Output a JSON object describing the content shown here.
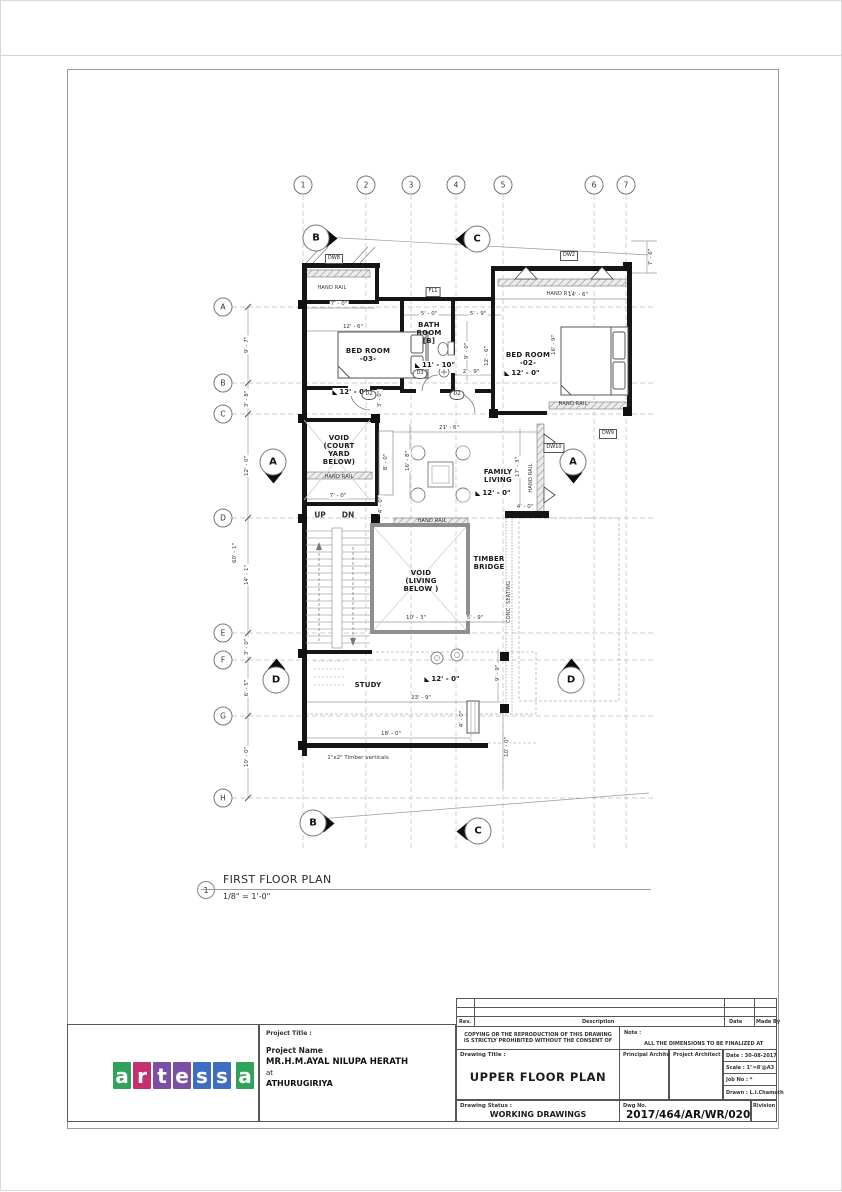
{
  "plan": {
    "number": "1",
    "title": "FIRST FLOOR PLAN",
    "scale": "1/8\" = 1'-0\""
  },
  "grid": {
    "cols": [
      "1",
      "2",
      "3",
      "4",
      "5",
      "6",
      "7"
    ],
    "rows": [
      "A",
      "B",
      "C",
      "D",
      "E",
      "F",
      "G",
      "H"
    ]
  },
  "left_dims": {
    "ab": "9' - 7\"",
    "bc": "3' - 8\"",
    "cd": "12' - 0\"",
    "de": "14' - 1\"",
    "ef": "3' - 0\"",
    "fg": "6' - 5\"",
    "gh": "10' - 0\"",
    "overall": "60' - 1\""
  },
  "section_markers": {
    "top_left": "B",
    "top_right": "C",
    "mid_left": "A",
    "mid_right": "A",
    "low_left": "D",
    "low_right": "D",
    "bottom_left": "B",
    "bottom_right": "C"
  },
  "rooms": {
    "bed3": "BED ROOM\n-03-",
    "bath": "BATH\nROOM\n[B]",
    "bed2": "BED ROOM\n-02-",
    "court": "VOID\n(COURT\nYARD\nBELOW)",
    "family": "FAMILY\nLIVING",
    "void_living": "VOID\n(LIVING\nBELOW )",
    "timber": "TIMBER\nBRIDGE",
    "study": "STUDY"
  },
  "levels": {
    "bed3": "12' - 0\"",
    "bath": "11' - 10\"",
    "bed2": "12' - 0\"",
    "family": "12' - 0\"",
    "study": "12' - 0\""
  },
  "annotations": {
    "hand_rail": "HAND RAIL",
    "up": "UP",
    "dn": "DN",
    "conc_seating": "CONC. SEATING",
    "timber_note": "1\"x2\" Timber verticals"
  },
  "tags": {
    "dw8": "DW8",
    "fl1": "FL1",
    "dw2": "DW2",
    "d3": "D3",
    "d2a": "D2",
    "d2b": "D2",
    "dw9": "DW9",
    "dw10": "DW10"
  },
  "dims": {
    "top_left_7_0": "7' - 0\"",
    "top_right_14_6": "14' - 6\"",
    "right_7_6": "7' - 6\"",
    "bed3_12_6": "12' - 6\"",
    "bath_5_0": "5' - 0\"",
    "bath_right_5_9": "5' - 9\"",
    "bath_9_0": "9' - 0\"",
    "corr_12_6": "12' - 6\"",
    "corr_2_9": "2' - 9\"",
    "d2_3_0": "3' - 0\"",
    "bed2_16_9": "16' - 9\"",
    "living_21_6": "21' - 6\"",
    "living_16_8": "16' - 8\"",
    "court_8_0": "8' - 0\"",
    "court_7_0": "7' - 0\"",
    "court_4_0": "4' - 0\"",
    "rail_17_3": "17' - 3\"",
    "dw10_4_0": "4' - 0\"",
    "void_10_3": "10' - 3\"",
    "void_5_9": "5' - 9\"",
    "study_23_9": "23' - 9\"",
    "study_18_0": "18' - 0\"",
    "study_4_0": "4' - 0\"",
    "study_9_9": "9' - 9\"",
    "study_10_0": "10' - 0\""
  },
  "logo": {
    "letters": [
      {
        "char": "a",
        "color": "#2fa25c"
      },
      {
        "char": "r",
        "color": "#c53070"
      },
      {
        "char": "t",
        "color": "#7b4fa5"
      },
      {
        "char": "e",
        "color": "#7b4fa5"
      },
      {
        "char": "s",
        "color": "#3d6ec2"
      },
      {
        "char": "s",
        "color": "#3d6ec2"
      },
      {
        "char": "a",
        "color": "#2fa25c"
      }
    ]
  },
  "titleblock": {
    "rev_header": {
      "rev": "Rev.",
      "description": "Description",
      "date": "Date",
      "made_by": "Made By"
    },
    "copyright": "COPYING OR THE REPRODUCTION OF THIS DRAWING IS STRICTLY PROHIBITED WITHOUT THE CONSENT OF",
    "note_label": "Note :",
    "note": "ALL THE DIMENSIONS TO BE FINALIZED AT SITE BEFORE CONSTRUCTION",
    "project_title_label": "Project Title :",
    "project_name_label": "Project Name",
    "client": "MR.H.M.AYAL NILUPA HERATH",
    "at": "at",
    "location": "ATHURUGIRIYA",
    "drawing_title_label": "Drawing Title :",
    "drawing_title": "UPPER FLOOR PLAN",
    "principal_architect_label": "Principal Architect :",
    "project_architect_label": "Project Architect :",
    "date": "Date : 30-08-2017",
    "scale": "Scale :  1\"=8'@A3",
    "job_no": "Job No :   *",
    "drawn": "Drawn : L.I.Chamath",
    "drawing_status_label": "Drawing Status :",
    "drawing_status": "WORKING DRAWINGS",
    "dwg_no_label": "Dwg No.",
    "dwg_no": "2017/464/AR/WR/0202",
    "revision_label": "Rivision"
  }
}
